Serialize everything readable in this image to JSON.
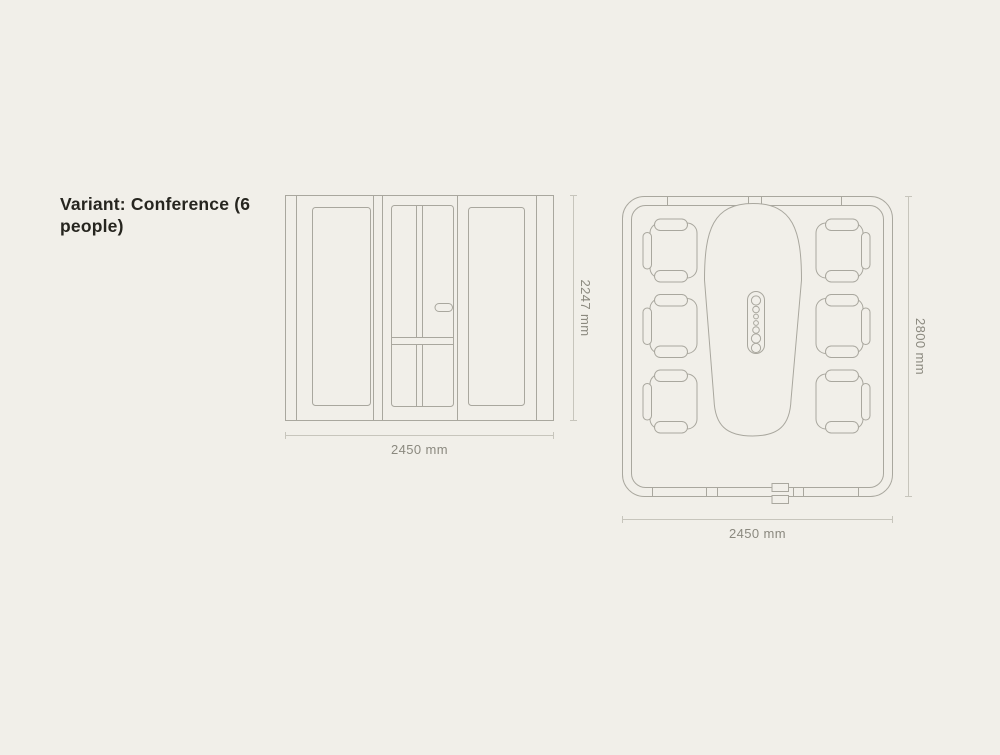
{
  "title": "Variant: Conference (6 people)",
  "front_view": {
    "name": "front elevation",
    "height_label": "2247 mm",
    "width_label": "2450 mm"
  },
  "plan_view": {
    "name": "top plan",
    "height_label": "2800 mm",
    "width_label": "2450 mm",
    "seat_count": 6
  },
  "colors": {
    "background": "#f1efe9",
    "line": "#a9a79e",
    "dimension_line": "#c7c5bc",
    "dimension_text": "#8b897f",
    "title_text": "#26251f"
  }
}
